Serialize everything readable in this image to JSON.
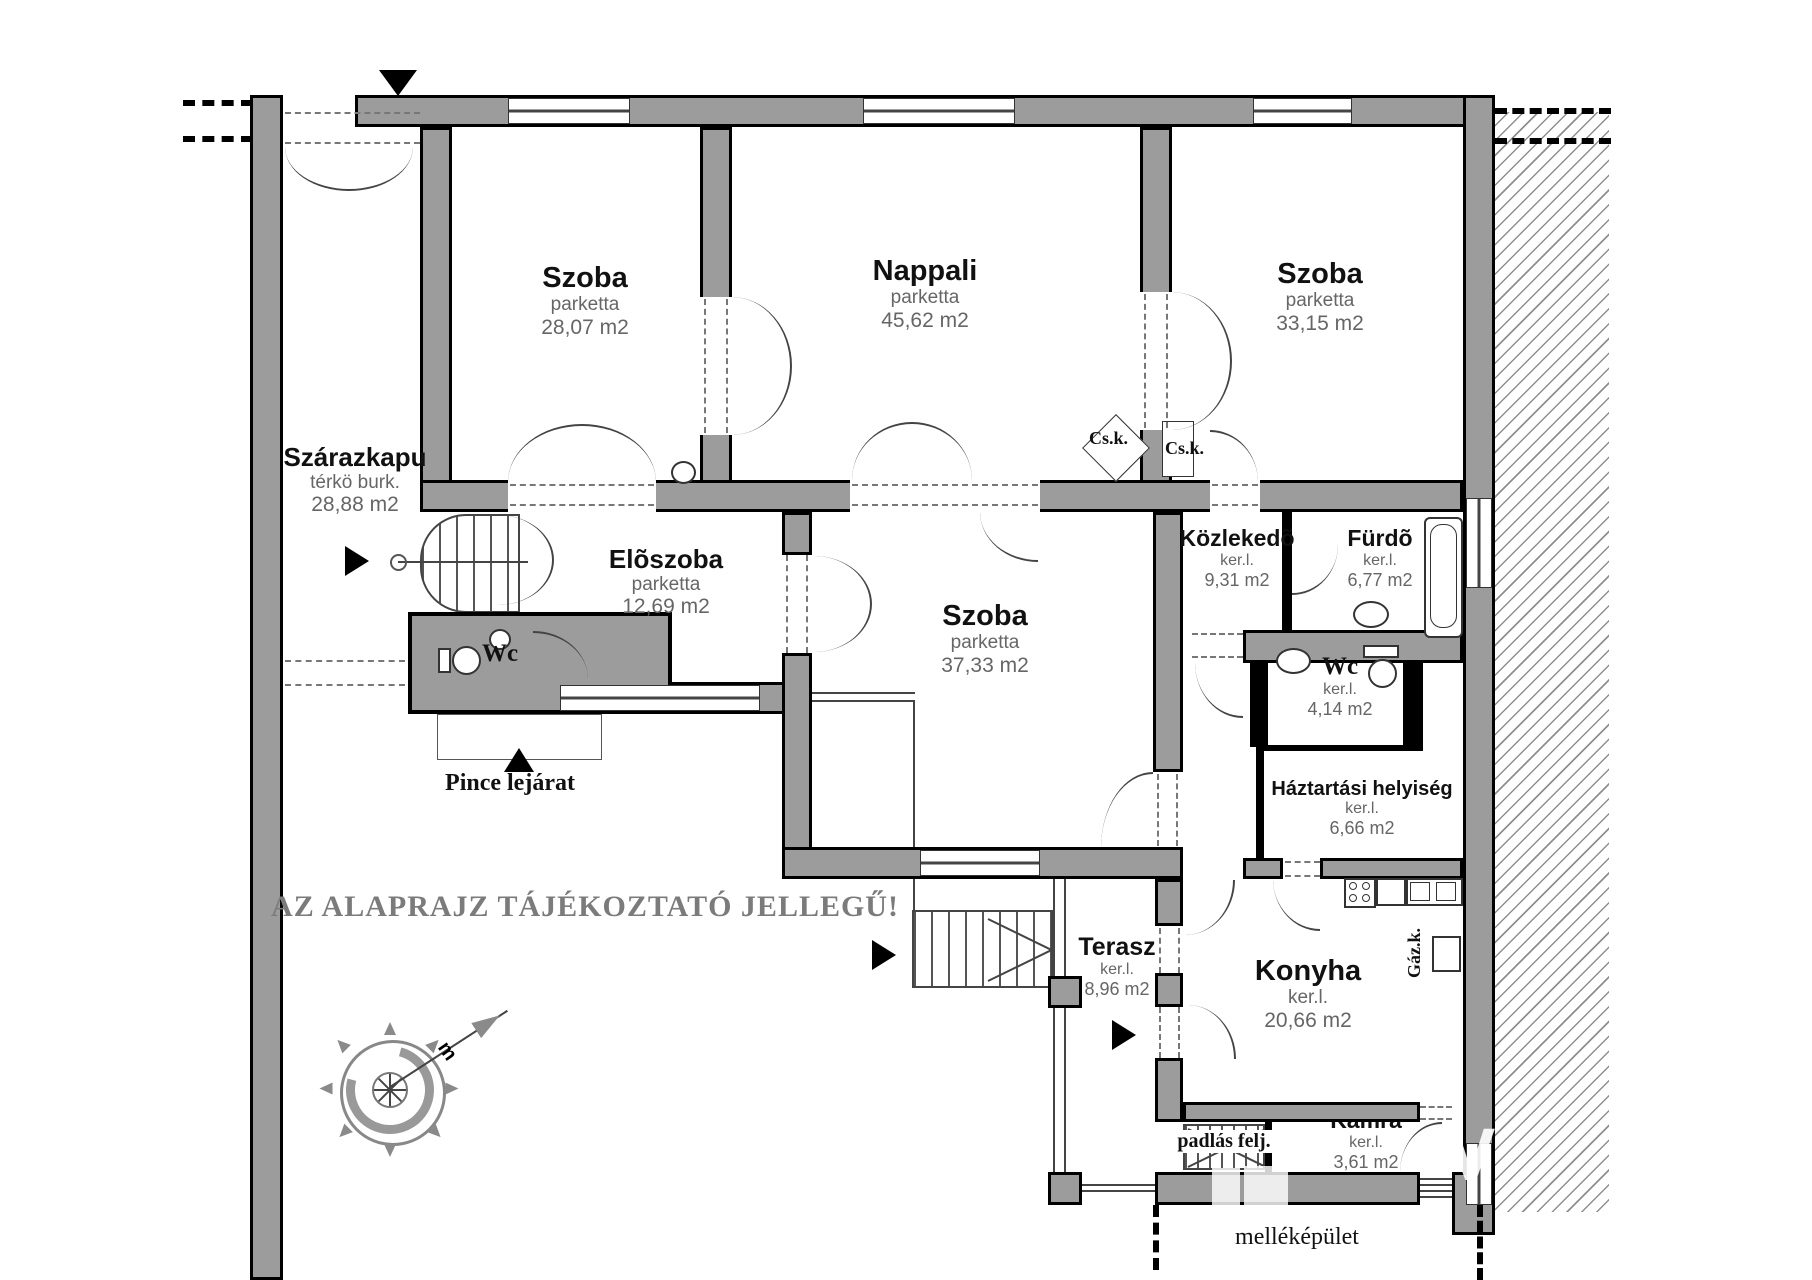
{
  "plan": {
    "disclaimer": "AZ ALAPRAJZ TÁJÉKOZTATÓ JELLEGŰ!",
    "rooms": [
      {
        "name": "Szoba",
        "floor": "parketta",
        "area": "28,07 m2"
      },
      {
        "name": "Nappali",
        "floor": "parketta",
        "area": "45,62 m2"
      },
      {
        "name": "Szoba",
        "floor": "parketta",
        "area": "33,15 m2"
      },
      {
        "name": "Szárazkapu",
        "floor": "térkö burk.",
        "area": "28,88 m2"
      },
      {
        "name": "Elõszoba",
        "floor": "parketta",
        "area": "12,69 m2"
      },
      {
        "name": "Szoba",
        "floor": "parketta",
        "area": "37,33 m2"
      },
      {
        "name": "Közlekedõ",
        "floor": "ker.l.",
        "area": "9,31 m2"
      },
      {
        "name": "Fürdõ",
        "floor": "ker.l.",
        "area": "6,77 m2"
      },
      {
        "name": "Wc"
      },
      {
        "name": "Wc",
        "floor": "ker.l.",
        "area": "4,14 m2"
      },
      {
        "name": "Háztartási helyiség",
        "floor": "ker.l.",
        "area": "6,66 m2"
      },
      {
        "name": "Terasz",
        "floor": "ker.l.",
        "area": "8,96 m2"
      },
      {
        "name": "Konyha",
        "floor": "ker.l.",
        "area": "20,66 m2"
      },
      {
        "name": "Kamra",
        "floor": "ker.l.",
        "area": "3,61 m2"
      }
    ],
    "annotations": {
      "pince_lejarat": "Pince lejárat",
      "padlas_felj": "padlás felj.",
      "mellekepulet": "melléképület",
      "csk_1": "Cs.k.",
      "csk_2": "Cs.k.",
      "gazk": "Gáz.k."
    }
  },
  "colors": {
    "wall": "#9c9c9c",
    "outline": "#000000",
    "label_muted": "#686868",
    "disclaimer_text": "#7b7b7b"
  }
}
